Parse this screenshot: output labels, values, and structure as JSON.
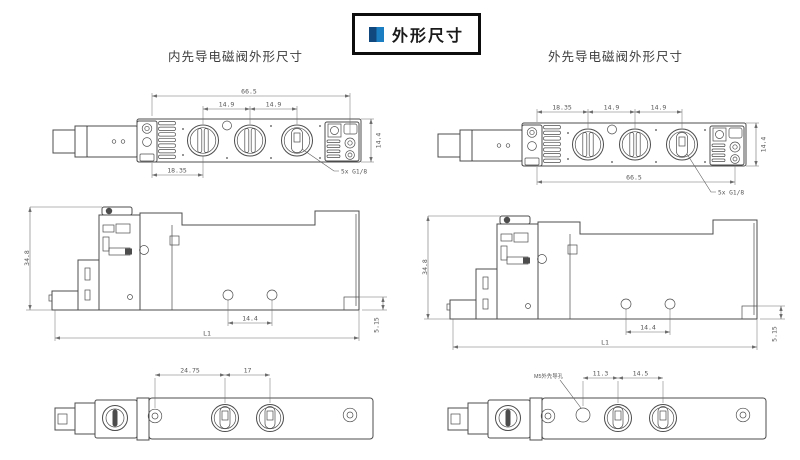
{
  "legend": {
    "title": "外形尺寸"
  },
  "left_section": {
    "heading": "内先导电磁阀外形尺寸",
    "top_view": {
      "overall": "66.5",
      "pitch1": "14.9",
      "pitch2": "14.9",
      "offset": "18.35",
      "width": "14.4",
      "port_note": "5x G1/8"
    },
    "side_view": {
      "height": "34.8",
      "hole_pitch": "14.4",
      "length": "L1",
      "step": "5.15"
    },
    "bottom_view": {
      "dim1": "24.75",
      "dim2": "17"
    }
  },
  "right_section": {
    "heading": "外先导电磁阀外形尺寸",
    "top_view": {
      "offset": "18.35",
      "pitch1": "14.9",
      "pitch2": "14.9",
      "overall": "66.5",
      "width": "14.4",
      "port_note": "5x G1/8"
    },
    "side_view": {
      "height": "34.8",
      "hole_pitch": "14.4",
      "length": "L1",
      "step": "5.15"
    },
    "bottom_view": {
      "pilot_note": "M5外先导孔",
      "dim1": "11.3",
      "dim2": "14.5"
    }
  }
}
